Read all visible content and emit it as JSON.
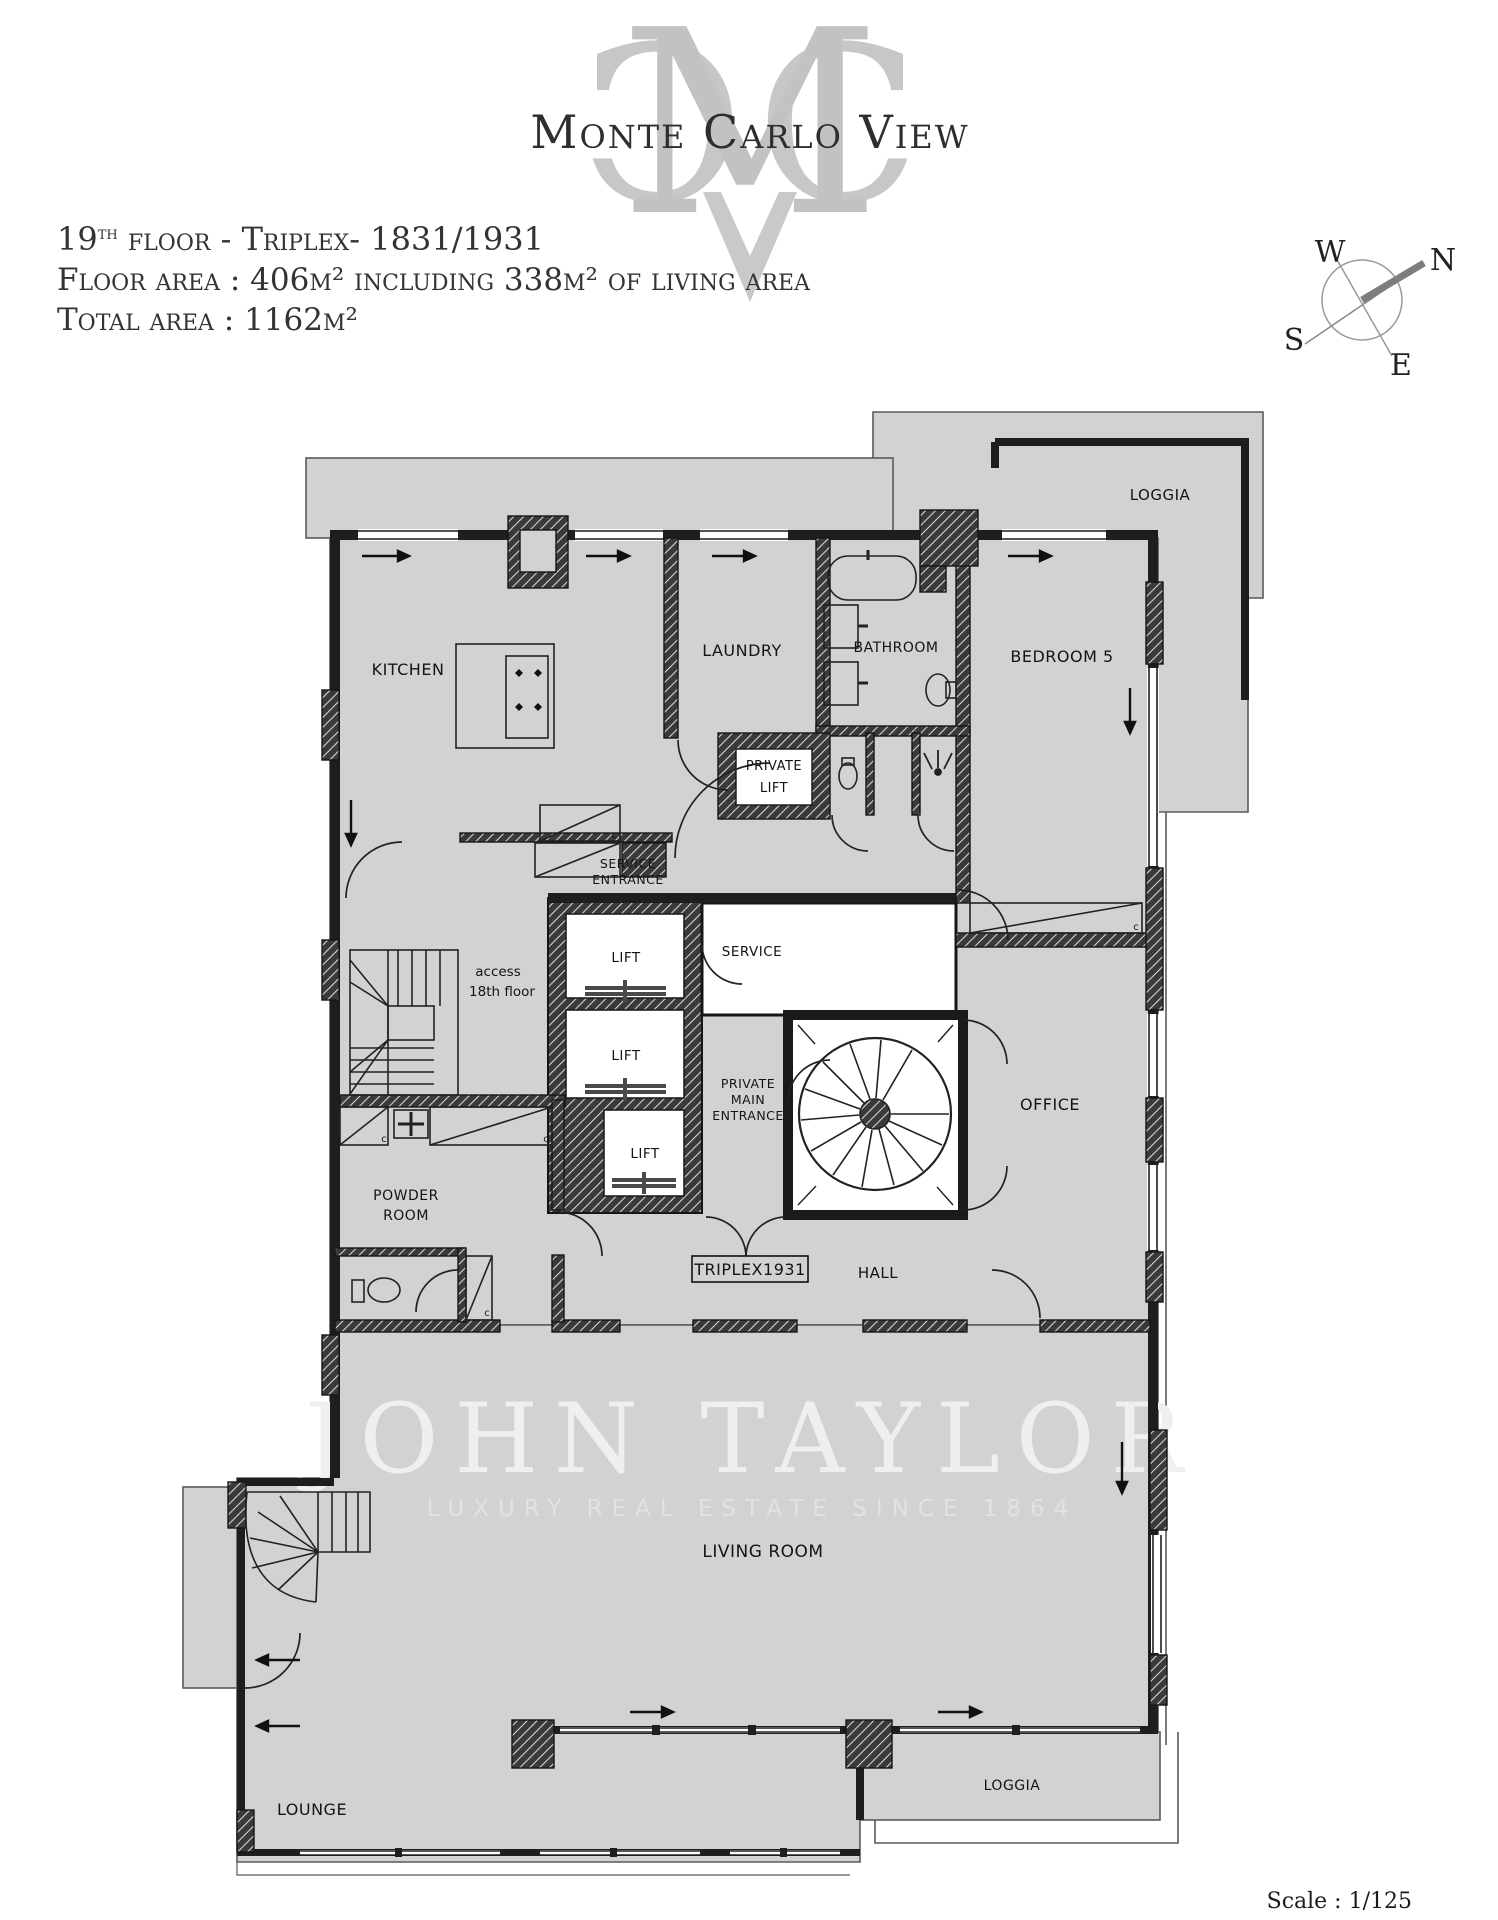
{
  "logo": {
    "monogram_left": "C",
    "monogram_mid": "M",
    "monogram_right": "C",
    "title": "Monte Carlo View"
  },
  "header": {
    "line1_num": "19",
    "line1_sup": "th",
    "line1_rest": " floor - Triplex- 1831/1931",
    "line2": "Floor area : 406m² including 338m² of living area",
    "line3": "Total area : 1162m²"
  },
  "compass": {
    "n": "N",
    "w": "W",
    "s": "S",
    "e": "E"
  },
  "plan": {
    "labels": {
      "loggia_top": "LOGGIA",
      "kitchen": "KITCHEN",
      "laundry": "LAUNDRY",
      "bathroom": "BATHROOM",
      "bedroom5": "BEDROOM 5",
      "private_lift_1": "PRIVATE",
      "private_lift_2": "LIFT",
      "service_entrance_1": "SERVICE",
      "service_entrance_2": "ENTRANCE",
      "lift": "LIFT",
      "service": "SERVICE",
      "access_1": "access",
      "access_2": "18th floor",
      "pme_1": "PRIVATE",
      "pme_2": "MAIN",
      "pme_3": "ENTRANCE",
      "office": "OFFICE",
      "powder_1": "POWDER",
      "powder_2": "ROOM",
      "triplex": "TRIPLEX1931",
      "hall": "HALL",
      "living_room": "LIVING  ROOM",
      "loggia_bottom": "LOGGIA",
      "lounge": "LOUNGE",
      "closet": "c"
    },
    "watermark": {
      "name": "JOHN TAYLOR",
      "tagline": "LUXURY REAL ESTATE SINCE 1864"
    }
  },
  "footer": {
    "scale_label": "Scale : 1/125"
  },
  "colors": {
    "floor": "#d2d2d2",
    "wall": "#1e1e1e",
    "outline": "#5a5a5a",
    "monogram": "#c7c7c7",
    "watermark": "#efefef"
  }
}
